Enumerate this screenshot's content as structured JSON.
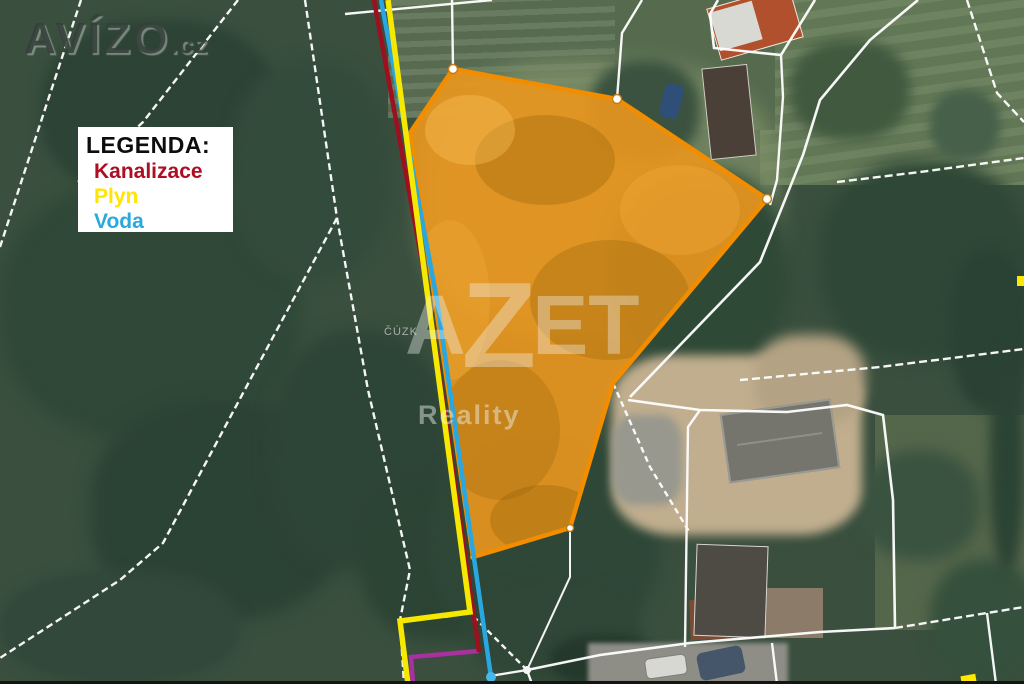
{
  "branding": {
    "site_name": "AVÍZO",
    "site_tld": ".cz",
    "agency_name": "AZET",
    "agency_name_parts": [
      "A",
      "Z",
      "ET"
    ],
    "agency_tagline": "Reality",
    "map_attribution": "ČÚZK"
  },
  "legend": {
    "title": "LEGENDA:",
    "items": [
      {
        "label": "Kanalizace",
        "color": "#ae0d22"
      },
      {
        "label": "Plyn",
        "color": "#ffe500"
      },
      {
        "label": "Voda",
        "color": "#2aa9e0"
      }
    ]
  },
  "parcel": {
    "fill_color": "#e8961e",
    "border_color": "#f28d00"
  },
  "utilities": {
    "kanalizace_color": "#9c1020",
    "plyn_color": "#f6e800",
    "voda_color": "#2aa7e0",
    "unlabeled_purple_color": "#a8309f"
  },
  "boundary_color": "#ffffff"
}
